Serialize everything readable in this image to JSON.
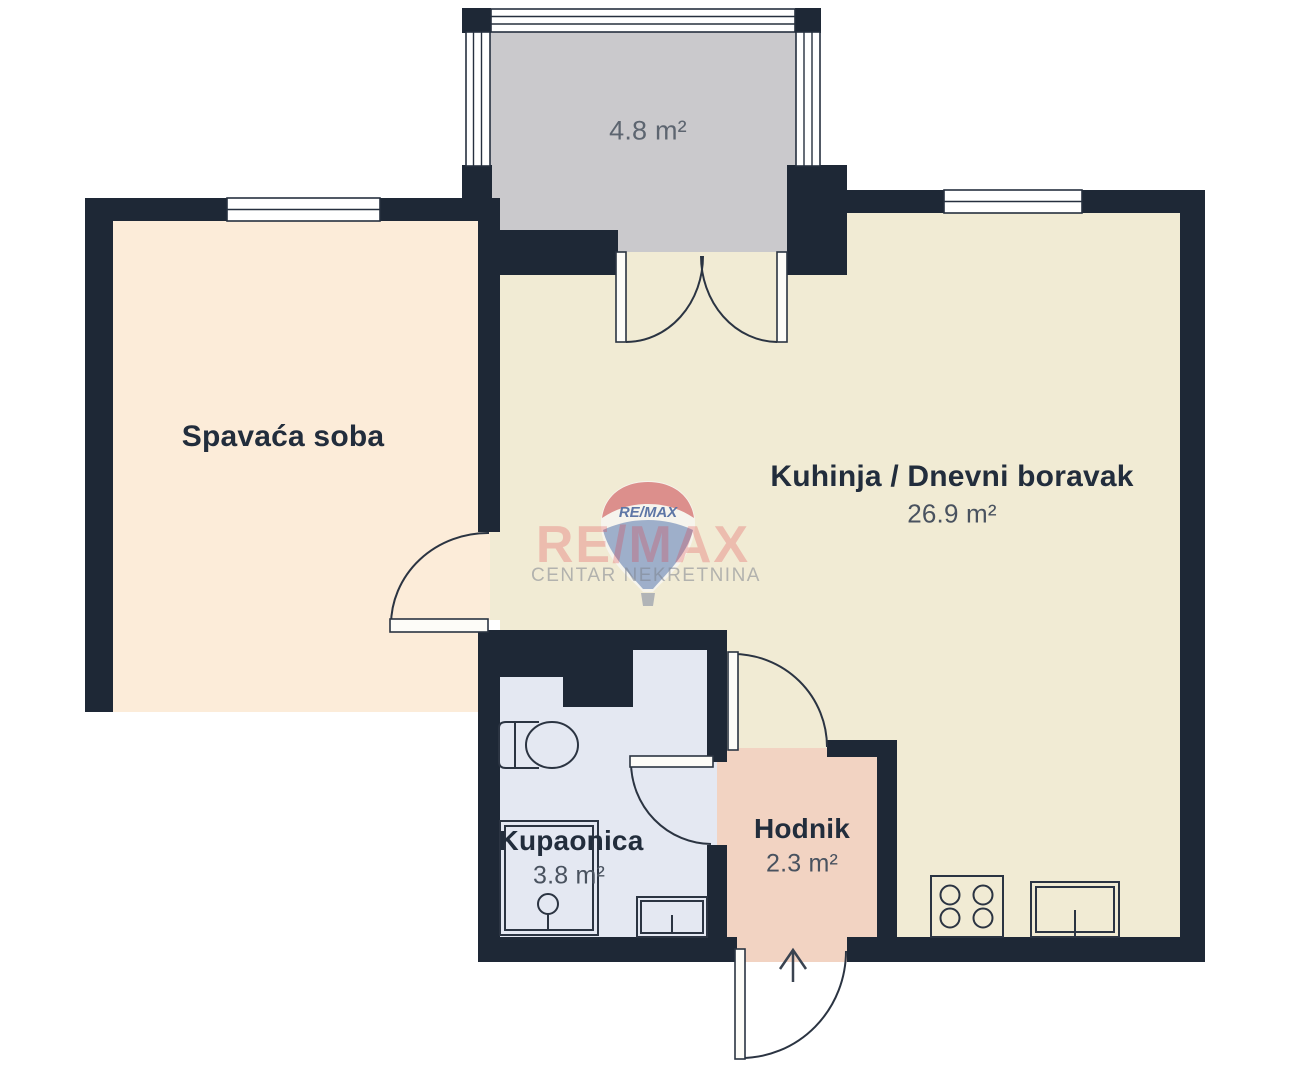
{
  "plan": {
    "rooms": {
      "bedroom": {
        "name": "Spavaća soba"
      },
      "kitchen_living": {
        "name": "Kuhinja / Dnevni boravak",
        "area": "26.9 m²"
      },
      "bathroom": {
        "name": "Kupaonica",
        "area": "3.8 m²"
      },
      "hallway": {
        "name": "Hodnik",
        "area": "2.3 m²"
      },
      "balcony": {
        "area": "4.8 m²"
      }
    },
    "watermark": {
      "brand": "RE/MAX",
      "subtitle": "CENTAR NEKRETNINA",
      "balloon_text": "RE/MAX"
    },
    "colors": {
      "wall": "#1e2836",
      "bedroom_fill": "#fcecd9",
      "kitchen_fill": "#f1ebd4",
      "bathroom_fill": "#e4e8f2",
      "hallway_fill": "#f2d3c2",
      "balcony_fill": "#cac9cc",
      "watermark_red": "#e13741",
      "balloon_blue": "#90a5c9",
      "balloon_red": "#d97f80"
    }
  }
}
